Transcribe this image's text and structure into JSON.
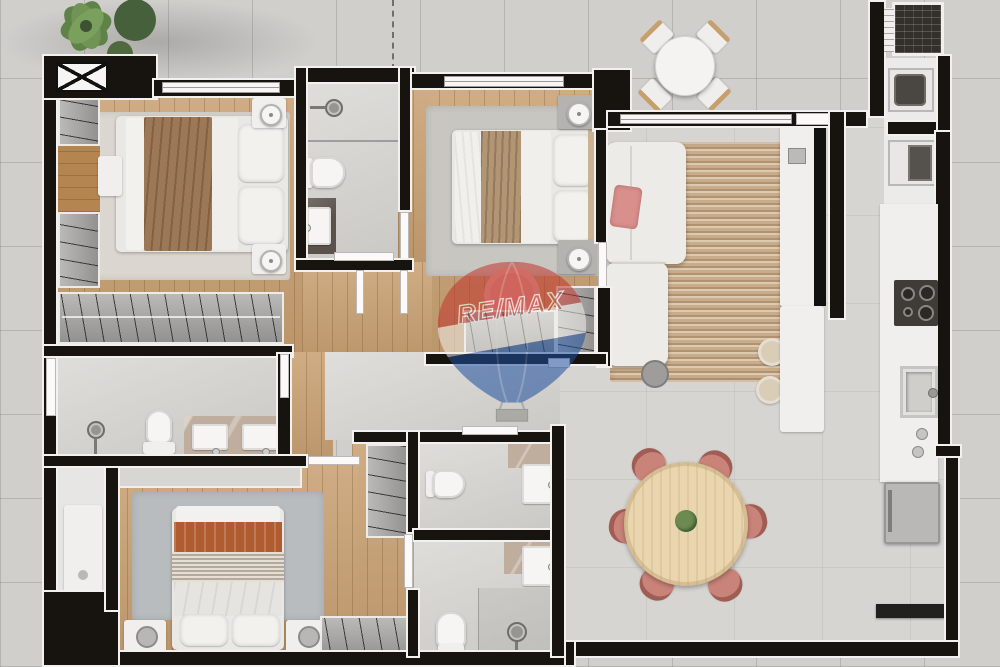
{
  "watermark": {
    "text": "RE/MAX",
    "balloon_red": "#c23a30",
    "balloon_blue": "#1f4f9e",
    "band_white": "#f2efe9",
    "opacity": 0.55
  },
  "palette": {
    "exterior_tile": "#d0cfcc",
    "interior_tile": "#d7d5d2",
    "wood_floor": "#c9a173",
    "wall": "#17140f",
    "wall_trim": "#f2f1ef",
    "closet_gray": "#a3a2a0",
    "white_furniture": "#f0efed",
    "sofa": "#edebe7",
    "jute_rug": "#c9ad8b",
    "pink_chair": "#ca8379",
    "rust_blanket": "#b05c30",
    "brown_blanket": "#9c7857",
    "tan_blanket": "#b29574",
    "dining_table_wood": "#e9d6af",
    "marble": "#bfae9e",
    "plant_green": "#5f8249"
  },
  "scene": {
    "type": "3d-rendered-apartment-floor-plan",
    "view": "top-down",
    "rooms": [
      {
        "name": "bedroom-1",
        "furniture": [
          "double-bed",
          "nightstand-lamps",
          "wardrobe",
          "dresser",
          "bench",
          "area-rug"
        ]
      },
      {
        "name": "bathroom-1",
        "furniture": [
          "shower-head",
          "toilet",
          "vanity-sink"
        ]
      },
      {
        "name": "bedroom-2",
        "furniture": [
          "double-bed",
          "nightstand-lamps",
          "area-rug",
          "round-pink-rug",
          "closet-rack",
          "wardrobe"
        ]
      },
      {
        "name": "living-room",
        "furniture": [
          "l-shaped-sofa",
          "pink-throw-pillow",
          "jute-rug",
          "side-table",
          "poufs",
          "tv-console",
          "tv"
        ]
      },
      {
        "name": "terrace",
        "furniture": [
          "round-table",
          "four-wood-chairs",
          "potted-plants"
        ]
      },
      {
        "name": "laundry-nook",
        "furniture": [
          "utility-grill",
          "washer",
          "oven"
        ]
      },
      {
        "name": "kitchen",
        "furniture": [
          "counter",
          "cooktop",
          "sink",
          "faucet",
          "refrigerator",
          "low-console"
        ]
      },
      {
        "name": "master-closet",
        "furniture": [
          "hanging-rack"
        ]
      },
      {
        "name": "master-bathroom",
        "furniture": [
          "shower-head",
          "toilet",
          "double-vanity"
        ]
      },
      {
        "name": "storage-room",
        "furniture": [
          "cabinet"
        ]
      },
      {
        "name": "bedroom-3",
        "furniture": [
          "double-bed",
          "nightstands",
          "wardrobe",
          "shelf-cabinet",
          "area-rug"
        ]
      },
      {
        "name": "bathroom-2",
        "furniture": [
          "toilet",
          "wall-sink"
        ]
      },
      {
        "name": "bathroom-3",
        "furniture": [
          "toilet",
          "wall-sink",
          "shower-head"
        ]
      },
      {
        "name": "dining-area",
        "furniture": [
          "round-wood-table",
          "six-pink-chairs",
          "center-plant"
        ]
      },
      {
        "name": "hallway",
        "furniture": [
          "closet-rack"
        ]
      }
    ]
  }
}
